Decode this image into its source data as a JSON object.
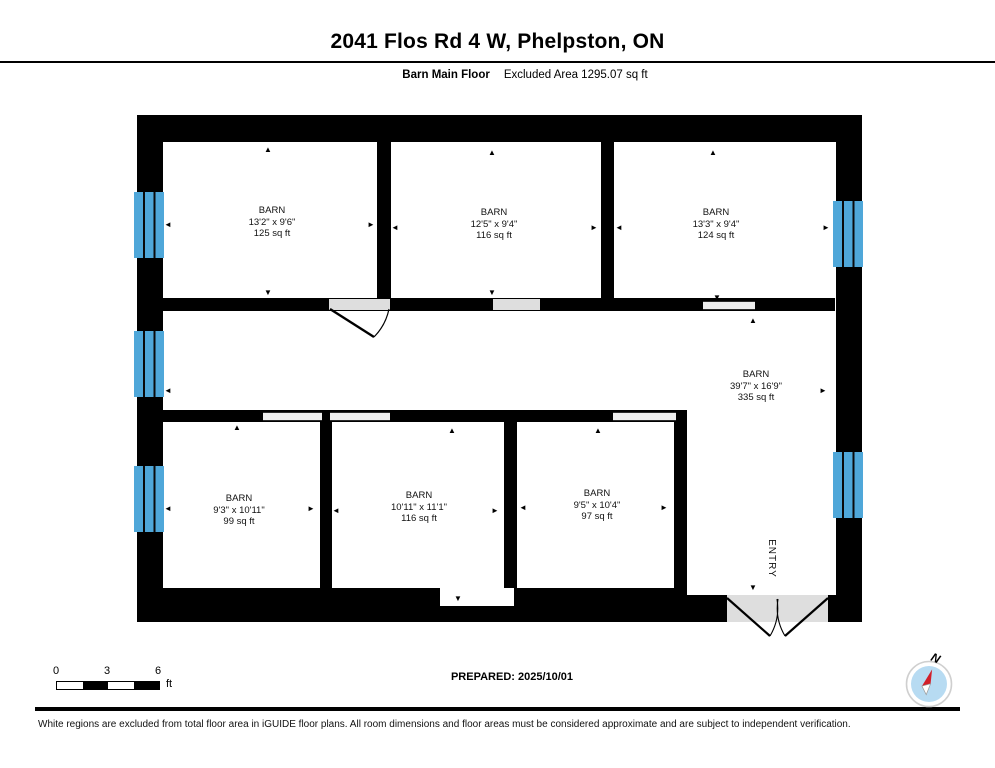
{
  "header": {
    "title": "2041 Flos Rd 4 W, Phelpston, ON",
    "floor_label": "Barn Main Floor",
    "excluded_area_label": "Excluded Area 1295.07 sq ft"
  },
  "plan": {
    "rooms": [
      {
        "name": "BARN",
        "dimensions": "13'2\" x 9'6\"",
        "area": "125 sq ft"
      },
      {
        "name": "BARN",
        "dimensions": "12'5\" x 9'4\"",
        "area": "116 sq ft"
      },
      {
        "name": "BARN",
        "dimensions": "13'3\" x 9'4\"",
        "area": "124 sq ft"
      },
      {
        "name": "BARN",
        "dimensions": "39'7\" x 16'9\"",
        "area": "335 sq ft"
      },
      {
        "name": "BARN",
        "dimensions": "9'3\" x 10'11\"",
        "area": "99 sq ft"
      },
      {
        "name": "BARN",
        "dimensions": "10'11\" x 11'1\"",
        "area": "116 sq ft"
      },
      {
        "name": "BARN",
        "dimensions": "9'5\" x 10'4\"",
        "area": "97 sq ft"
      }
    ],
    "entry_label": "ENTRY"
  },
  "scale_bar": {
    "tick_0": "0",
    "tick_1": "3",
    "tick_2": "6",
    "unit": "ft"
  },
  "prepared_label": "PREPARED: 2025/10/01",
  "compass": {
    "north_label": "N"
  },
  "footer": {
    "disclaimer": "White regions are excluded from total floor area in iGUIDE floor plans. All room dimensions and floor areas must be considered approximate and are subject to independent verification."
  },
  "icons": {
    "arrow_up": "▲",
    "arrow_down": "▼",
    "arrow_left": "◄",
    "arrow_right": "►",
    "compass": "compass-rose-icon",
    "window": "window-blue-bar",
    "door": "door-swing-arc"
  },
  "colors": {
    "wall": "#000000",
    "window_blue": "#4fa7d9",
    "opening_gray": "#dedede",
    "compass_fill": "#b7dbf2",
    "compass_needle_red": "#d21f2a"
  }
}
